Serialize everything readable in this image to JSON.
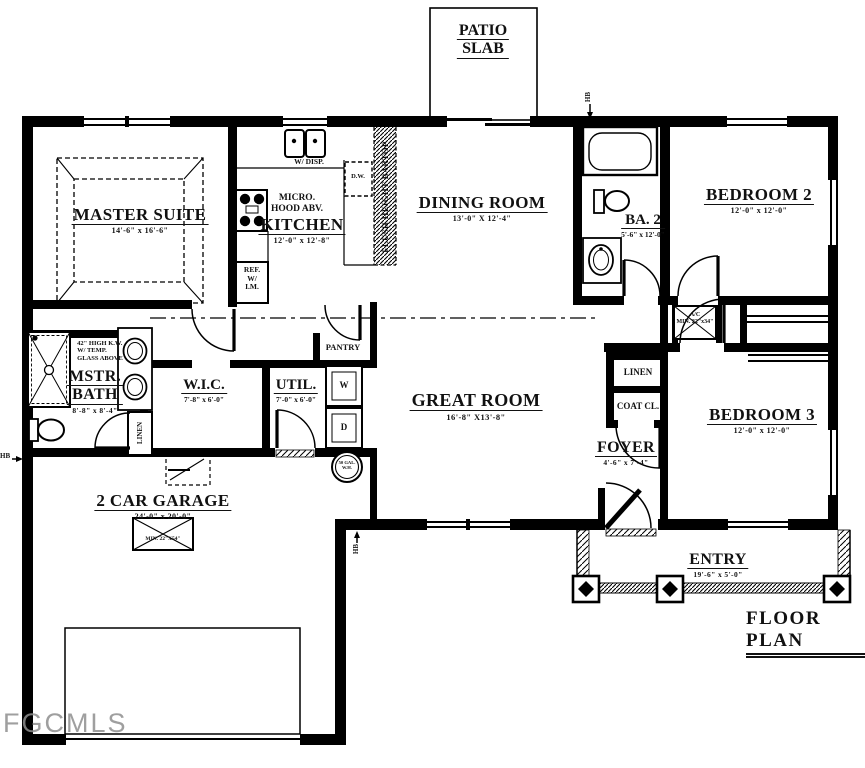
{
  "title": "FLOOR PLAN",
  "watermark": "FGCMLS",
  "patio": {
    "line1": "PATIO",
    "line2": "SLAB"
  },
  "rooms": {
    "master_suite": {
      "name": "MASTER SUITE",
      "dims": "14'-6\" x 16'-6\""
    },
    "kitchen": {
      "name": "KITCHEN",
      "dims": "12'-0\" x 12'-8\""
    },
    "dining_room": {
      "name": "DINING ROOM",
      "dims": "13'-0\" X 12'-4\""
    },
    "bath2": {
      "name": "BA. 2",
      "dims": "5'-6\" x 12'-0\""
    },
    "bedroom2": {
      "name": "BEDROOM 2",
      "dims": "12'-0\" x 12'-0\""
    },
    "master_bath": {
      "line1": "MSTR.",
      "line2": "BATH",
      "dims": "8'-8\" x 8'-4\""
    },
    "wic": {
      "name": "W.I.C.",
      "dims": "7'-8\" x 6'-0\""
    },
    "util": {
      "name": "UTIL.",
      "dims": "7'-0\" x 6'-0\""
    },
    "great_room": {
      "name": "GREAT ROOM",
      "dims": "16'-8\" X13'-8\""
    },
    "foyer": {
      "name": "FOYER",
      "dims": "4'-6\" x 7'-4\""
    },
    "bedroom3": {
      "name": "BEDROOM 3",
      "dims": "12'-0\" x 12'-0\""
    },
    "garage": {
      "name": "2 CAR GARAGE",
      "dims": "24'-0\" x 20'-0\""
    },
    "entry": {
      "name": "ENTRY",
      "dims": "19'-6\" x 5'-0\""
    }
  },
  "fixtures": {
    "sink_disposal": "W/ DISP.",
    "dishwasher": "D.W.",
    "micro_line1": "MICRO.",
    "micro_line2": "HOOD ABV.",
    "fridge_line1": "REF.",
    "fridge_line2": "W/",
    "fridge_line3": "I.M.",
    "bartop": "FLUSH HEIGHT BARTOP",
    "pantry": "PANTRY",
    "linen_hall": "LINEN",
    "coat_closet": "COAT CL.",
    "linen_master": "LINEN",
    "washer": "W",
    "dryer": "D",
    "water_heater_line1": "50 GAL.",
    "water_heater_line2": "W.H.",
    "ac_line1": "A/C",
    "ac_line2": "MIN. 22\"x34\"",
    "attic_access": "MIN. 22\"X54\"",
    "knee_wall_line1": "42\" HIGH K.W.",
    "knee_wall_line2": "W/ TEMP.",
    "knee_wall_line3": "GLASS ABOVE",
    "hose_bib": "HB"
  },
  "colors": {
    "line": "#000000",
    "text": "#111111",
    "watermark": "#8f8f8f"
  }
}
